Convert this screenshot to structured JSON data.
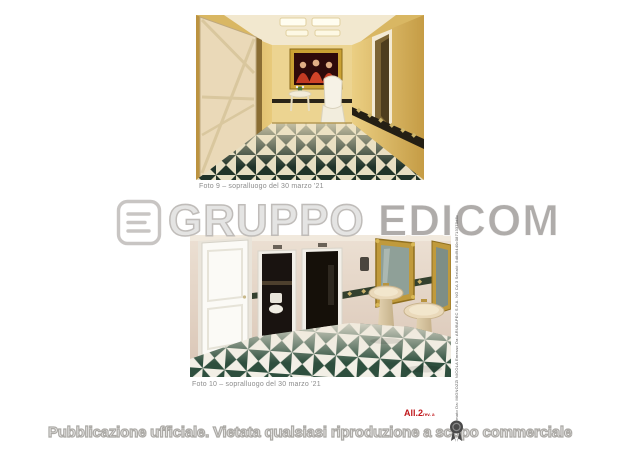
{
  "page": {
    "background": "#ffffff"
  },
  "photos": [
    {
      "caption": "Foto 9 – sopralluogo del 30 marzo '21",
      "alt": "corridoio con pavimento a scacchi"
    },
    {
      "caption": "Foto 10 – sopralluogo del 30 marzo '21",
      "alt": "bagno con lavabi a colonna e pavimento a scacchi"
    }
  ],
  "watermark": {
    "brand_prefix": "GRUPPO ",
    "brand_suffix": "EDICOM",
    "logo_icon": "edicom-e-logo",
    "color": "#bdbab7"
  },
  "attachment_label": {
    "text": "All.2",
    "suffix": "rev. a",
    "color": "#c0181c"
  },
  "signature_stamp": {
    "text": "Firmato Da: MIGNOZZI NICOLA Emesso Da: ARUBAPEC S.P.A. NG CA 3 Serial#: 5d8d9440c08713370d8c"
  },
  "footer_banner": {
    "text": "Pubblicazione ufficiale. Vietata qualsiasi riproduzione a scopo commerciale",
    "icon": "ribbon-seal-icon"
  }
}
